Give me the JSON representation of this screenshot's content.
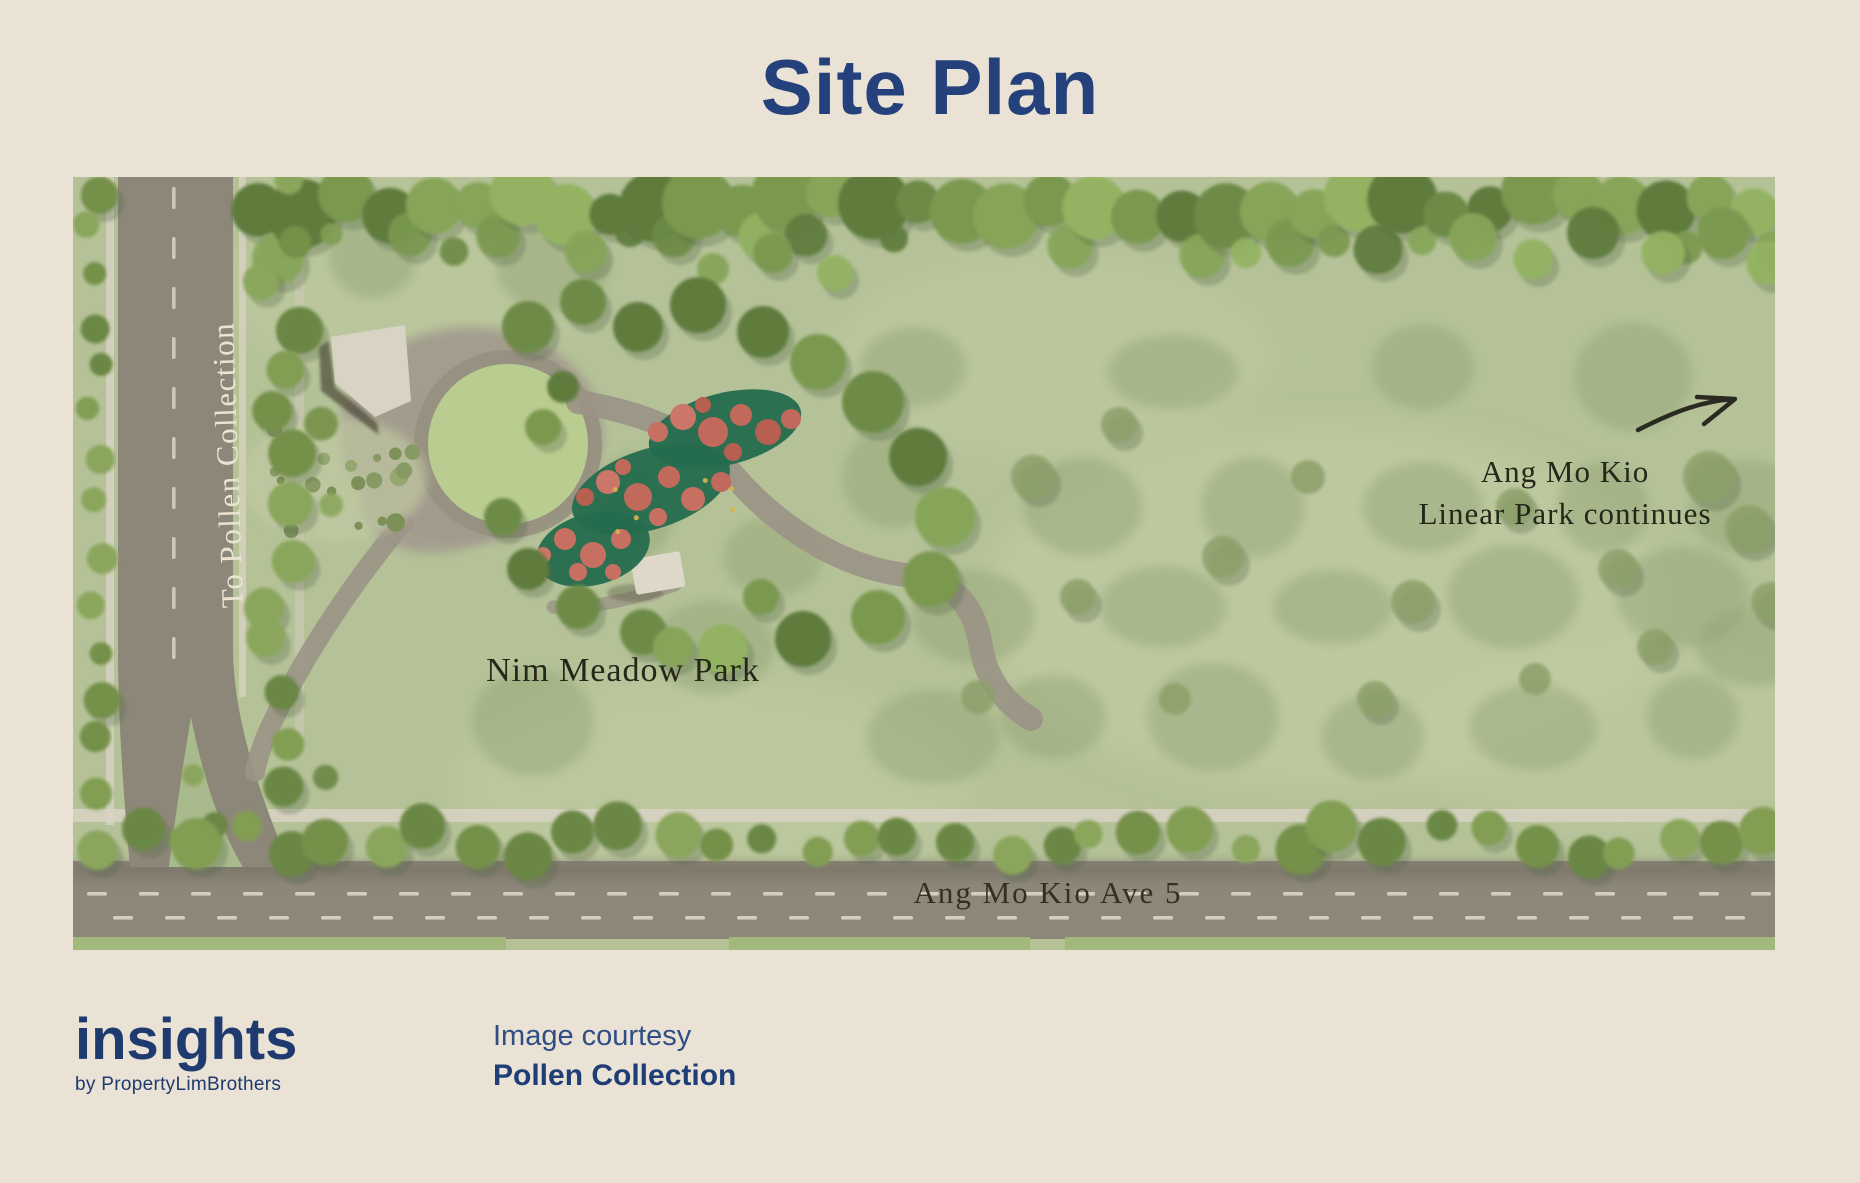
{
  "header": {
    "title": "Site Plan"
  },
  "map": {
    "labels": {
      "to_pollen_collection": "To Pollen Collection",
      "park_name": "Nim Meadow Park",
      "linear_park_line1": "Ang Mo Kio",
      "linear_park_line2": "Linear Park continues",
      "avenue": "Ang Mo Kio Ave 5"
    },
    "icons": {
      "direction_arrow": "curved-arrow-up-right"
    }
  },
  "footer": {
    "logo": {
      "wordmark": "insights",
      "byline": "by PropertyLimBrothers"
    },
    "credit": {
      "label": "Image courtesy",
      "source": "Pollen Collection"
    }
  },
  "colors": {
    "background": "#eae2d5",
    "title_navy": "#24417c",
    "brand_navy": "#1e3a6e",
    "map_label_dark": "#262619",
    "map_label_light": "#ece4d2",
    "meadow_green": "#b5c298",
    "road_gray": "#8d8779",
    "playground_red": "#c16a5b",
    "playground_green": "#256b4e"
  }
}
